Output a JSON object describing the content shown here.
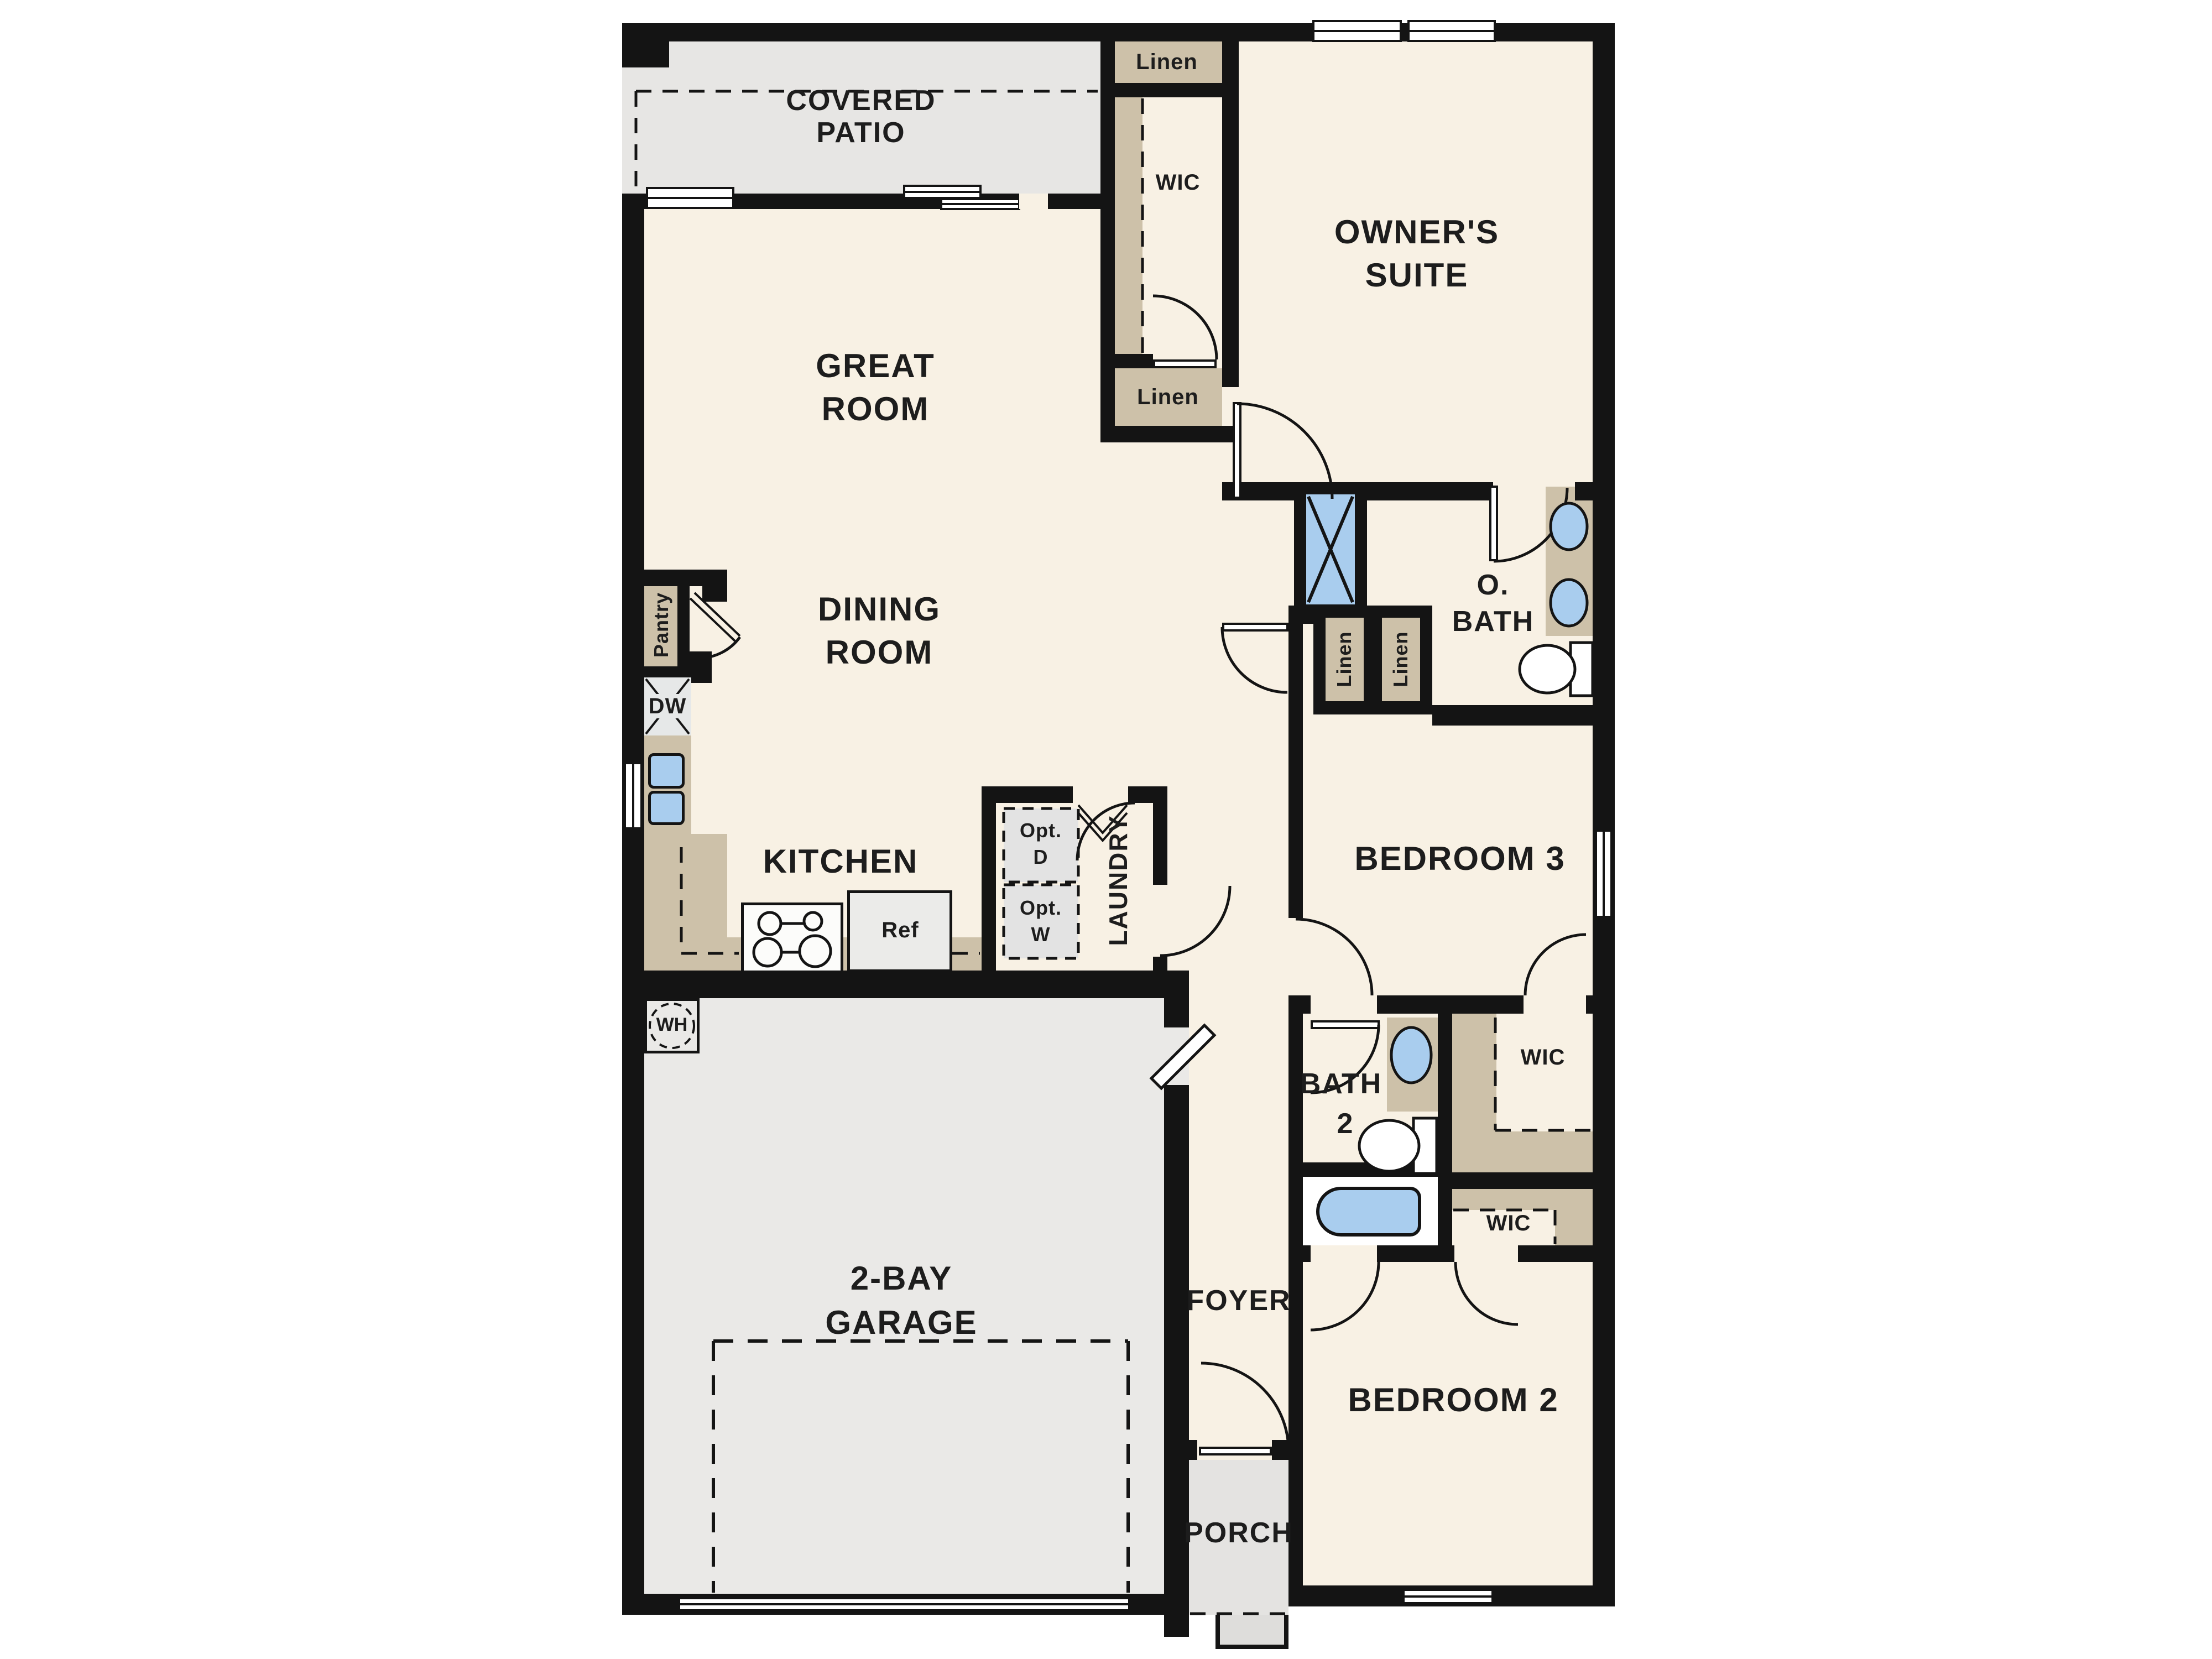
{
  "plan": {
    "rooms": {
      "covered_patio_1": "COVERED",
      "covered_patio_2": "PATIO",
      "great_room_1": "GREAT",
      "great_room_2": "ROOM",
      "owners_suite_1": "OWNER'S",
      "owners_suite_2": "SUITE",
      "dining_room_1": "DINING",
      "dining_room_2": "ROOM",
      "kitchen": "KITCHEN",
      "garage_1": "2-BAY",
      "garage_2": "GARAGE",
      "owners_bath_1": "O.",
      "owners_bath_2": "BATH",
      "bath2_1": "BATH",
      "bath2_2": "2",
      "laundry": "LAUNDRY",
      "bedroom3": "BEDROOM 3",
      "bedroom2": "BEDROOM 2",
      "foyer": "FOYER",
      "porch": "PORCH"
    },
    "closets": {
      "linen_top": "Linen",
      "linen_mid": "Linen",
      "linen_v1": "Linen",
      "linen_v2": "Linen",
      "wic_suite": "WIC",
      "wic_bed3": "WIC",
      "wic_bed2": "WIC",
      "pantry": "Pantry"
    },
    "appliances": {
      "dishwasher": "DW",
      "refrigerator": "Ref",
      "water_heater": "WH",
      "opt_dryer_1": "Opt.",
      "opt_dryer_2": "D",
      "opt_washer_1": "Opt.",
      "opt_washer_2": "W"
    },
    "colors": {
      "wall": "#141414",
      "floor": "#f8f1e4",
      "patio": "#e7e6e4",
      "garage": "#eae9e7",
      "closet_tan": "#cdc1a9",
      "fixture_blue": "#a9cdee"
    }
  }
}
